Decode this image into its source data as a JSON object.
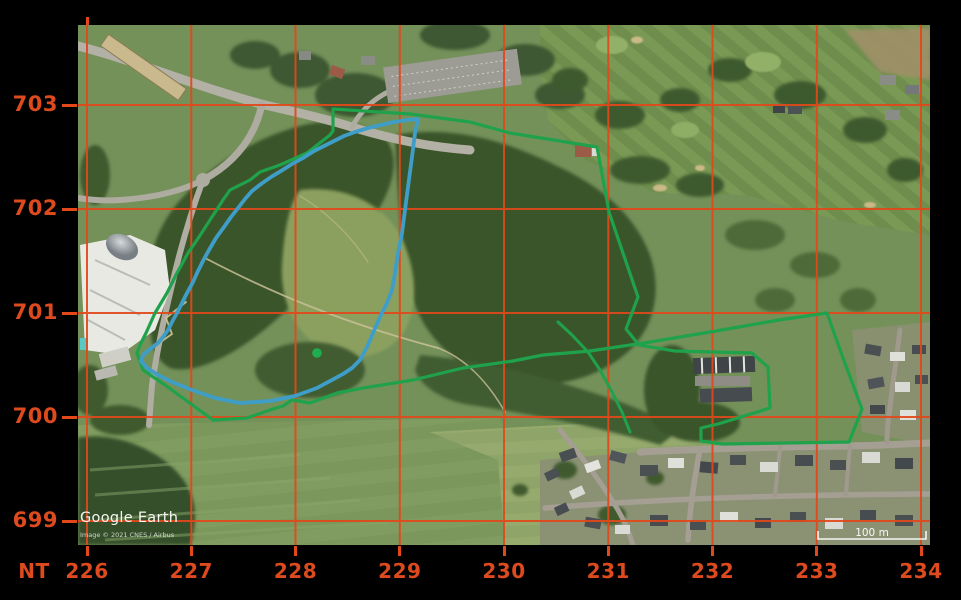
{
  "window": {
    "background": "#000000"
  },
  "grid": {
    "zone_label": "NT",
    "x_labels": [
      "226",
      "227",
      "228",
      "229",
      "230",
      "231",
      "232",
      "233",
      "234"
    ],
    "y_labels": [
      "703",
      "702",
      "701",
      "700",
      "699"
    ],
    "line_color": "#e2481a",
    "label_color": "#dd4a1d"
  },
  "map": {
    "attribution": {
      "brand": "Google Earth",
      "copyright": "Image © 2021 CNES / Airbus"
    },
    "scale_bar": {
      "label": "100 m"
    },
    "overlays": {
      "outer_boundary_color": "#1fa24b",
      "inner_boundary_color": "#3f9ec7",
      "marker_color": "#1fae4d"
    }
  }
}
